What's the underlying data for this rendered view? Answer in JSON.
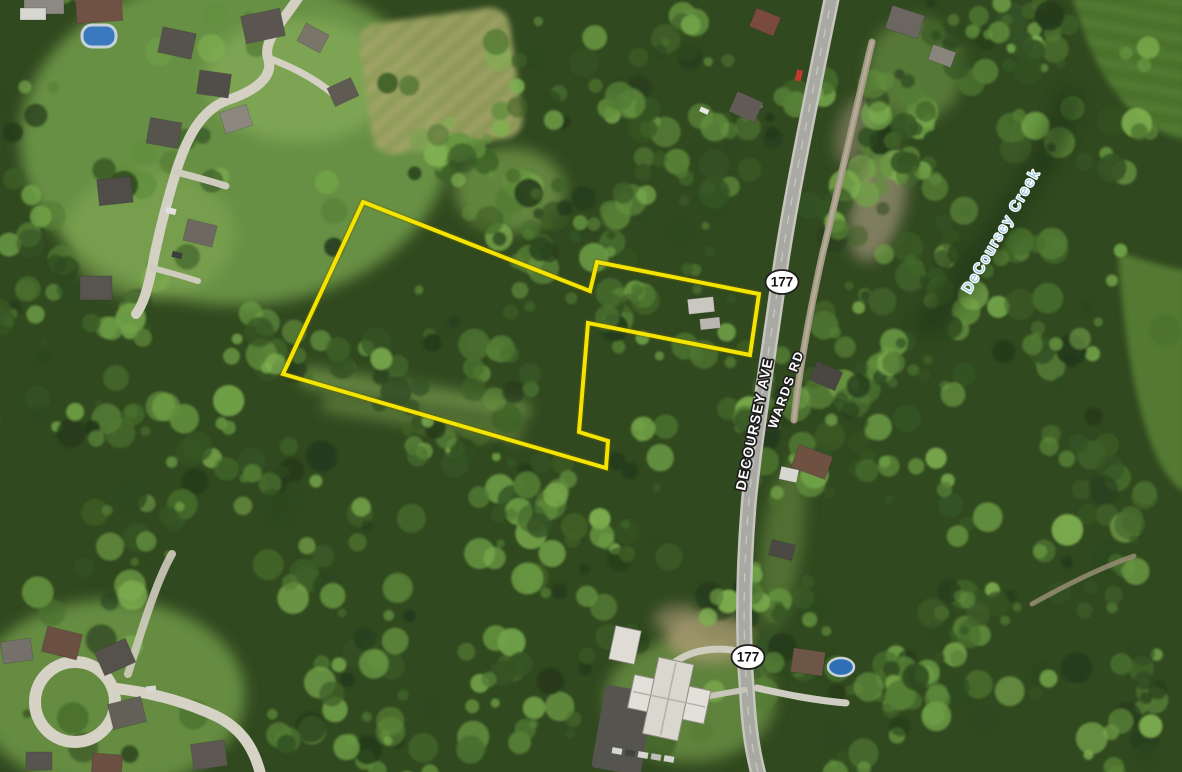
{
  "map_labels": {
    "primary_road": "DECOURSEY AVE",
    "secondary_road": "WARDS RD",
    "waterway": "DeCoursey Creek"
  },
  "route_shields": [
    {
      "number": "177"
    },
    {
      "number": "177"
    }
  ],
  "parcel": {
    "points": "363,202 590,291 597,262 759,294 750,355 588,323 579,432 608,441 606,468 283,374",
    "color": "#f5e400"
  },
  "colors": {
    "road_label_text": "#ffffff",
    "water_label_text": "#92c7df",
    "route_shield_fill": "#ffffff",
    "route_shield_border": "#1f1f1f",
    "route_shield_number": "#111111"
  }
}
